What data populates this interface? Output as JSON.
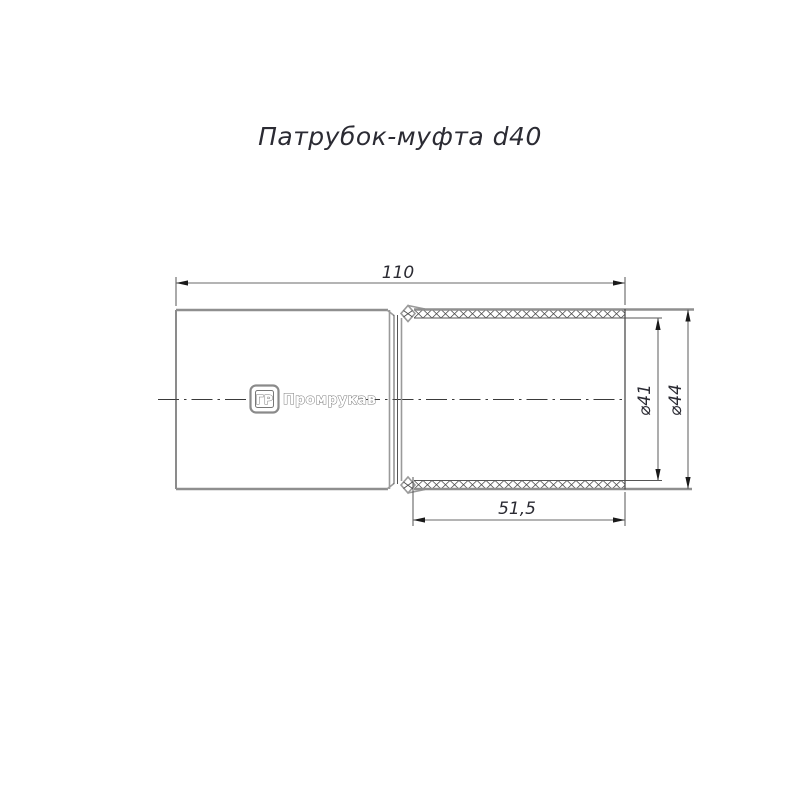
{
  "drawing": {
    "title": "Патрубок-муфта d40",
    "dimensions": {
      "overall_length": "110",
      "corrugated_length": "51,5",
      "inner_diameter": "⌀41",
      "outer_diameter": "⌀44"
    },
    "logo": {
      "badge": "ГР",
      "brand": "Промрукав"
    },
    "colors": {
      "background": "#ffffff",
      "outline_gray": "#8f8f8f",
      "thin_line": "#555555",
      "text": "#2b2b33"
    }
  }
}
